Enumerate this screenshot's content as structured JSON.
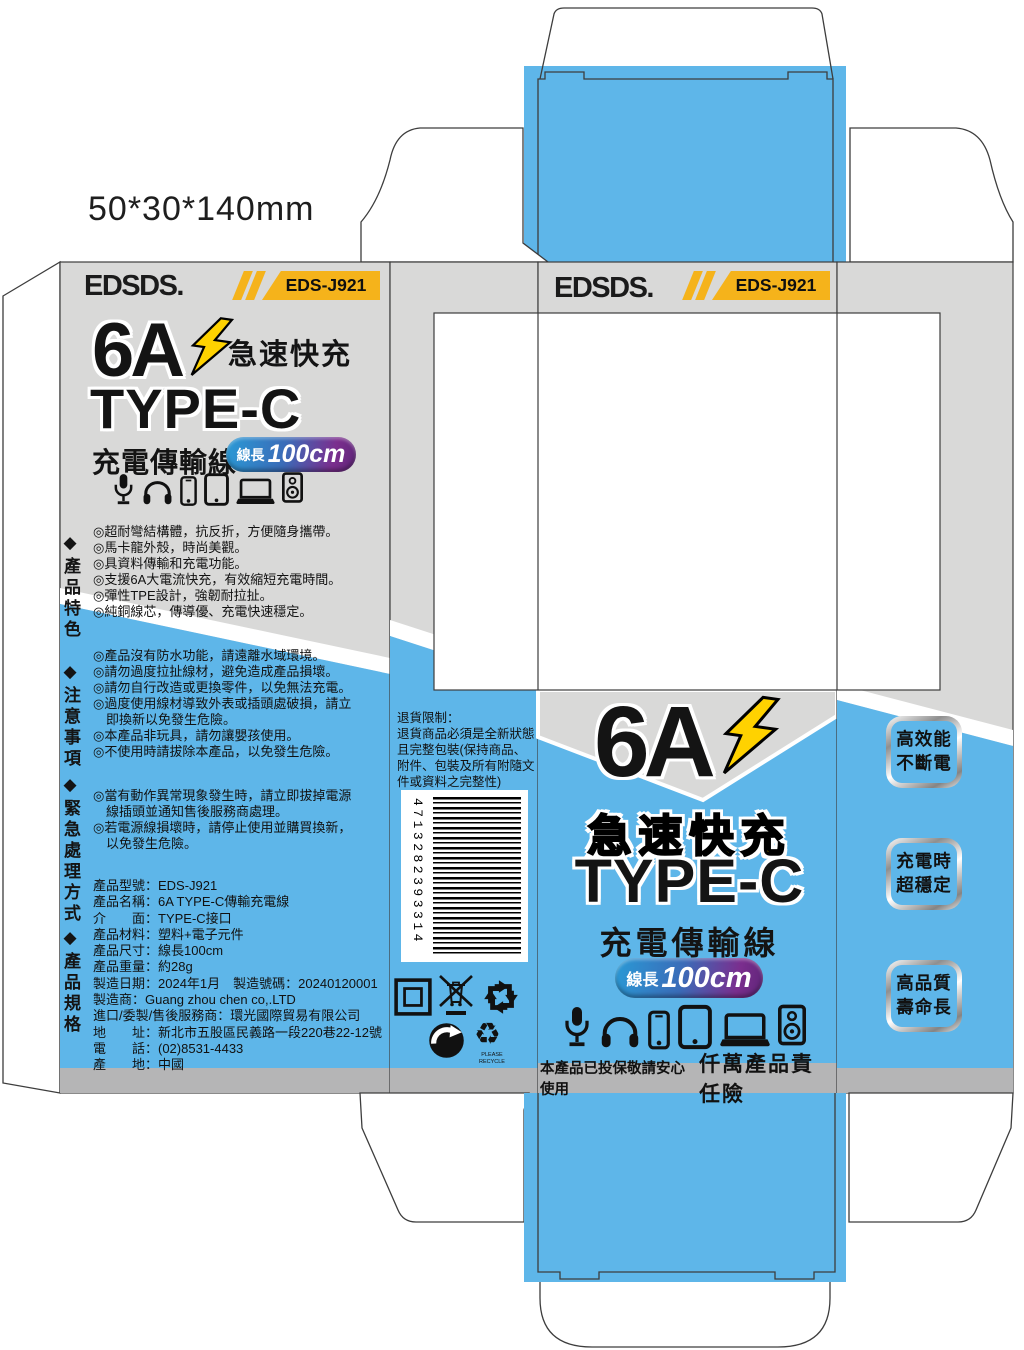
{
  "meta": {
    "dimensions_label": "50*30*140mm"
  },
  "brand": {
    "name": "EDSDS.",
    "model": "EDS-J921"
  },
  "product": {
    "amp": "6A",
    "fast_charge": "急速快充",
    "connector": "TYPE-C",
    "cable_name": "充電傳輸線",
    "length_label": "線長",
    "length_value": "100cm"
  },
  "back_panel": {
    "features_title": "◆產品特色",
    "features": [
      "◎超耐彎結構體，抗反折，方便隨身攜帶。",
      "◎馬卡龍外殼，時尚美觀。",
      "◎具資料傳輸和充電功能。",
      "◎支援6A大電流快充，有效縮短充電時間。",
      "◎彈性TPE設計，強韌耐拉扯。",
      "◎純銅線芯，傳導優、充電快速穩定。"
    ],
    "cautions_title": "◆注意事項",
    "cautions": [
      "◎產品沒有防水功能，請遠離水域環境。",
      "◎請勿過度拉扯線材，避免造成產品損壞。",
      "◎請勿自行改造或更換零件，以免無法充電。",
      "◎過度使用線材導致外表或插頭處破損，請立",
      "　即換新以免發生危險。",
      "◎本產品非玩具，請勿讓嬰孩使用。",
      "◎不使用時請拔除本產品，以免發生危險。"
    ],
    "emergency_title": "◆緊急處理方式",
    "emergency": [
      "◎當有動作異常現象發生時，請立即拔掉電源",
      "　線插頭並通知售後服務商處理。",
      "◎若電源線損壞時，請停止使用並購買換新，",
      "　以免發生危險。"
    ],
    "specs_title": "◆產品規格",
    "specs": [
      "產品型號：EDS-J921",
      "產品名稱：6A TYPE-C傳輸充電線",
      "介　　面：TYPE-C接口",
      "產品材料：塑料+電子元件",
      "產品尺寸：線長100cm",
      "產品重量：約28g",
      "製造日期：2024年1月　製造號碼：20240120001",
      "製造商：Guang zhou chen co,.LTD",
      "進口/委製/售後服務商：環光國際貿易有限公司",
      "地　　址：新北市五股區民義路一段220巷22-12號",
      "電　　話：(02)8531-4433",
      "產　　地：中國"
    ]
  },
  "side_panel": {
    "return_policy": [
      "退貨限制：",
      "退貨商品必須是全新狀態",
      "且完整包裝(保持商品、",
      "附件、包裝及所有附隨文",
      "件或資料之完整性)"
    ],
    "barcode_number": "4713282393314",
    "recycle_caption": "PLEASE RECYCLE"
  },
  "front_panel": {
    "insurance_note": "本產品已投保敬請安心使用",
    "insurance_title": "仟萬產品責任險"
  },
  "right_flap": {
    "badges": [
      {
        "line1": "高效能",
        "line2": "不斷電"
      },
      {
        "line1": "充電時",
        "line2": "超穩定"
      },
      {
        "line1": "高品質",
        "line2": "壽命長"
      }
    ]
  },
  "icons": {
    "device_icons": [
      "microphone",
      "headphones",
      "smartphone",
      "tablet",
      "laptop",
      "speaker"
    ],
    "recycle_icons": [
      "packaging-box",
      "no-trash-bin",
      "recycling-arrows-square",
      "green-dot",
      "recycle-triangle"
    ],
    "logo_icon": "lightning-bolt"
  },
  "colors": {
    "panel_gray": "#d9d9d8",
    "strip_gray": "#b5b5b6",
    "blue": "#5eb6e9",
    "badge_yellow": "#f5b31b",
    "bolt_yellow": "#ffd200",
    "burst_yellow": "#ffe400",
    "pill_gradient_start": "#2a9ad6",
    "pill_gradient_end": "#7b2e8e"
  }
}
